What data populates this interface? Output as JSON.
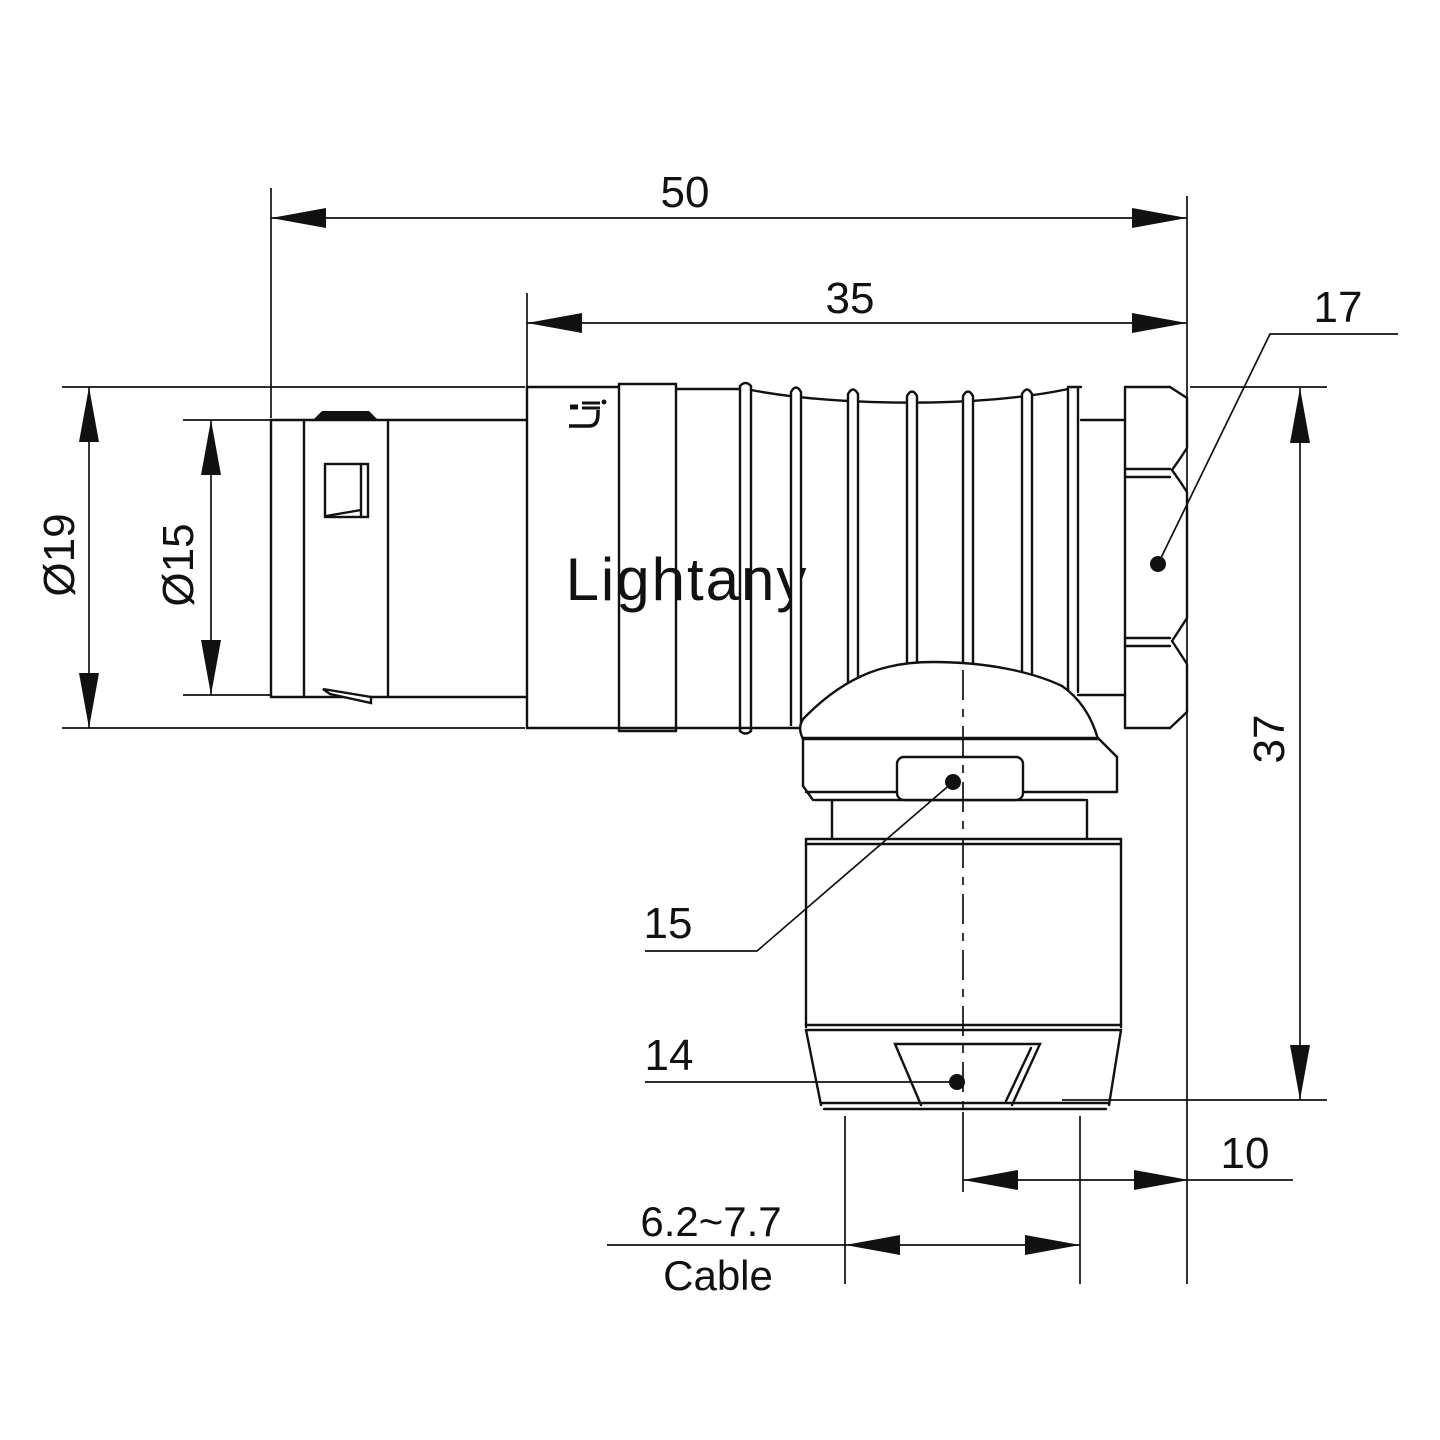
{
  "watermark": {
    "text": "Lightany",
    "color": "#f2bfc1"
  },
  "dimensions": {
    "overall_length": "50",
    "rear_body_length": "35",
    "hex_nut_size": "17",
    "outer_diameter": "Ø19",
    "inner_diameter": "Ø15",
    "total_height": "37",
    "axis_to_face_offset": "10",
    "gland_ref": "15",
    "clamp_nut_ref": "14",
    "cable_range": "6.2~7.7",
    "cable_label": "Cable"
  },
  "colors": {
    "line": "#111111",
    "background": "#ffffff",
    "watermark": "#f2bfc1"
  }
}
